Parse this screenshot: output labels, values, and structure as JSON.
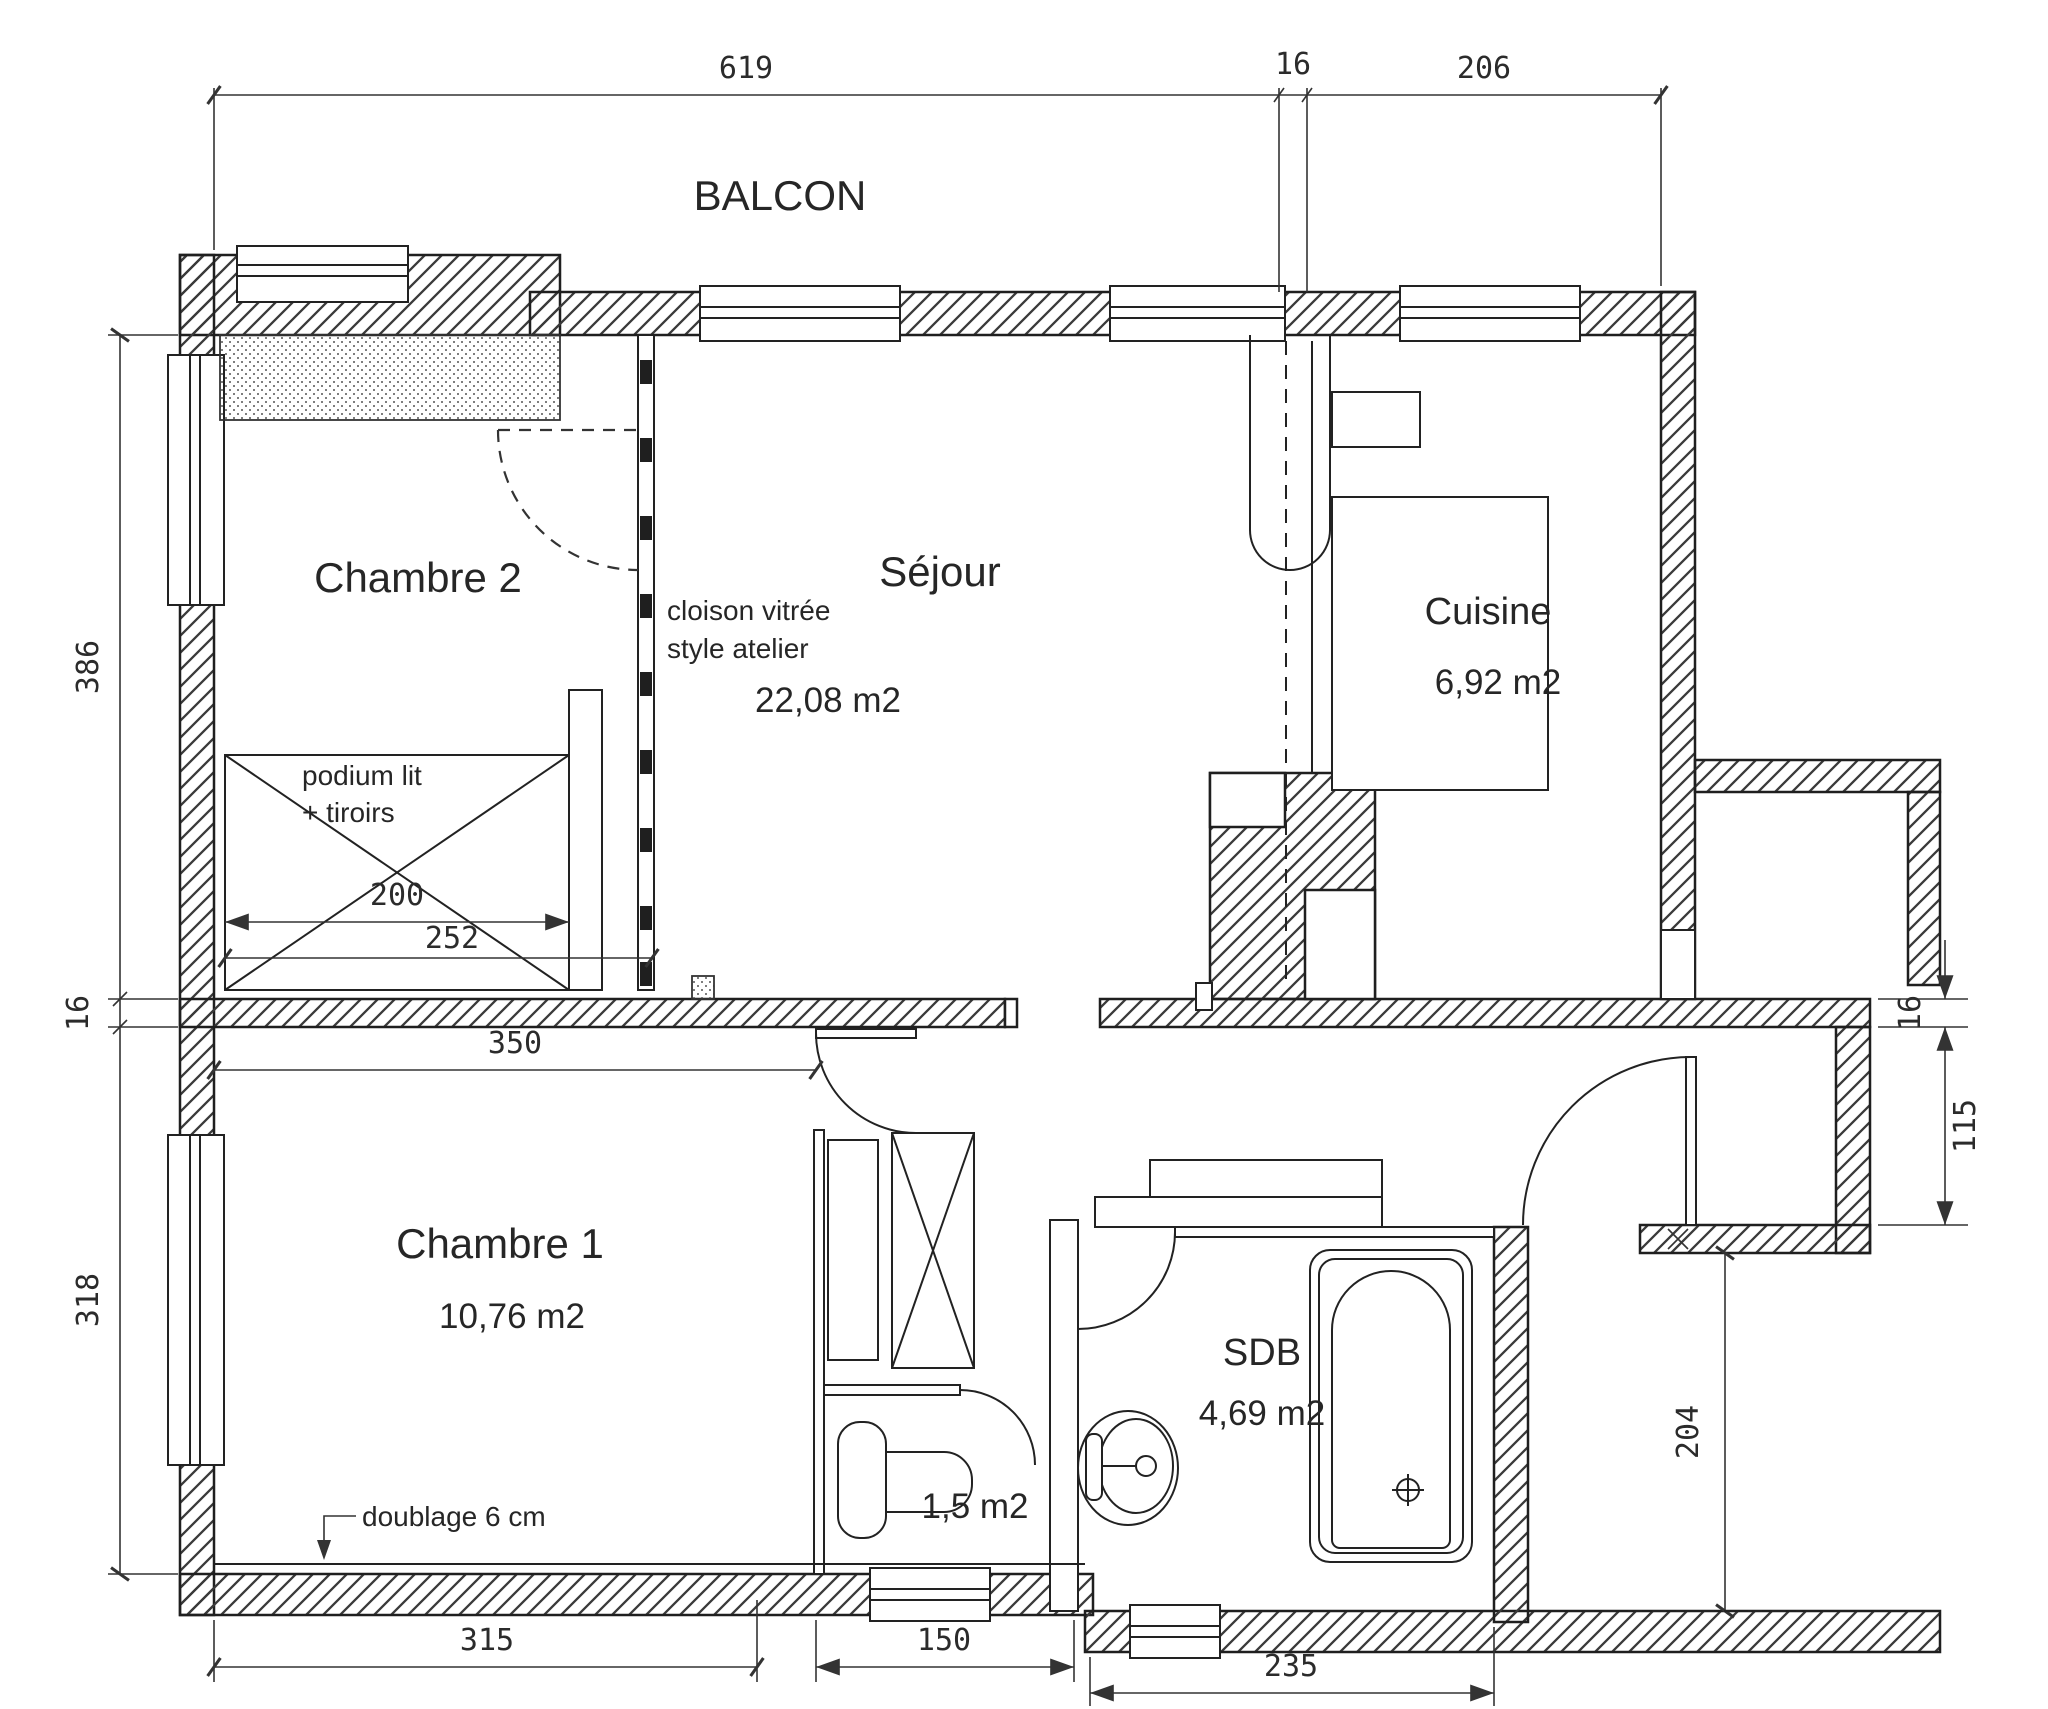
{
  "drawing": {
    "kind": "apartment floor plan",
    "line_color": "#222222",
    "background": "#ffffff"
  },
  "rooms": {
    "balcon": {
      "label": "BALCON"
    },
    "chambre2": {
      "label": "Chambre 2"
    },
    "sejour": {
      "label": "Séjour",
      "area": "22,08 m2"
    },
    "cuisine": {
      "label": "Cuisine",
      "area": "6,92 m2"
    },
    "chambre1": {
      "label": "Chambre 1",
      "area": "10,76 m2"
    },
    "sdb": {
      "label": "SDB",
      "area": "4,69 m2"
    },
    "wc": {
      "area": "1,5 m2"
    }
  },
  "annotations": {
    "cloison": {
      "line1": "cloison vitrée",
      "line2": "style atelier"
    },
    "podium": {
      "line1": "podium lit",
      "line2": "+ tiroirs"
    },
    "doublage": "doublage 6 cm"
  },
  "dimensions": {
    "top": [
      "619",
      "16",
      "206"
    ],
    "left": [
      "386",
      "16",
      "318"
    ],
    "right": [
      "16",
      "115",
      "204"
    ],
    "bottom": [
      "315",
      "150",
      "235"
    ],
    "podium": [
      "200",
      "252"
    ],
    "chambre1_width": "350"
  }
}
